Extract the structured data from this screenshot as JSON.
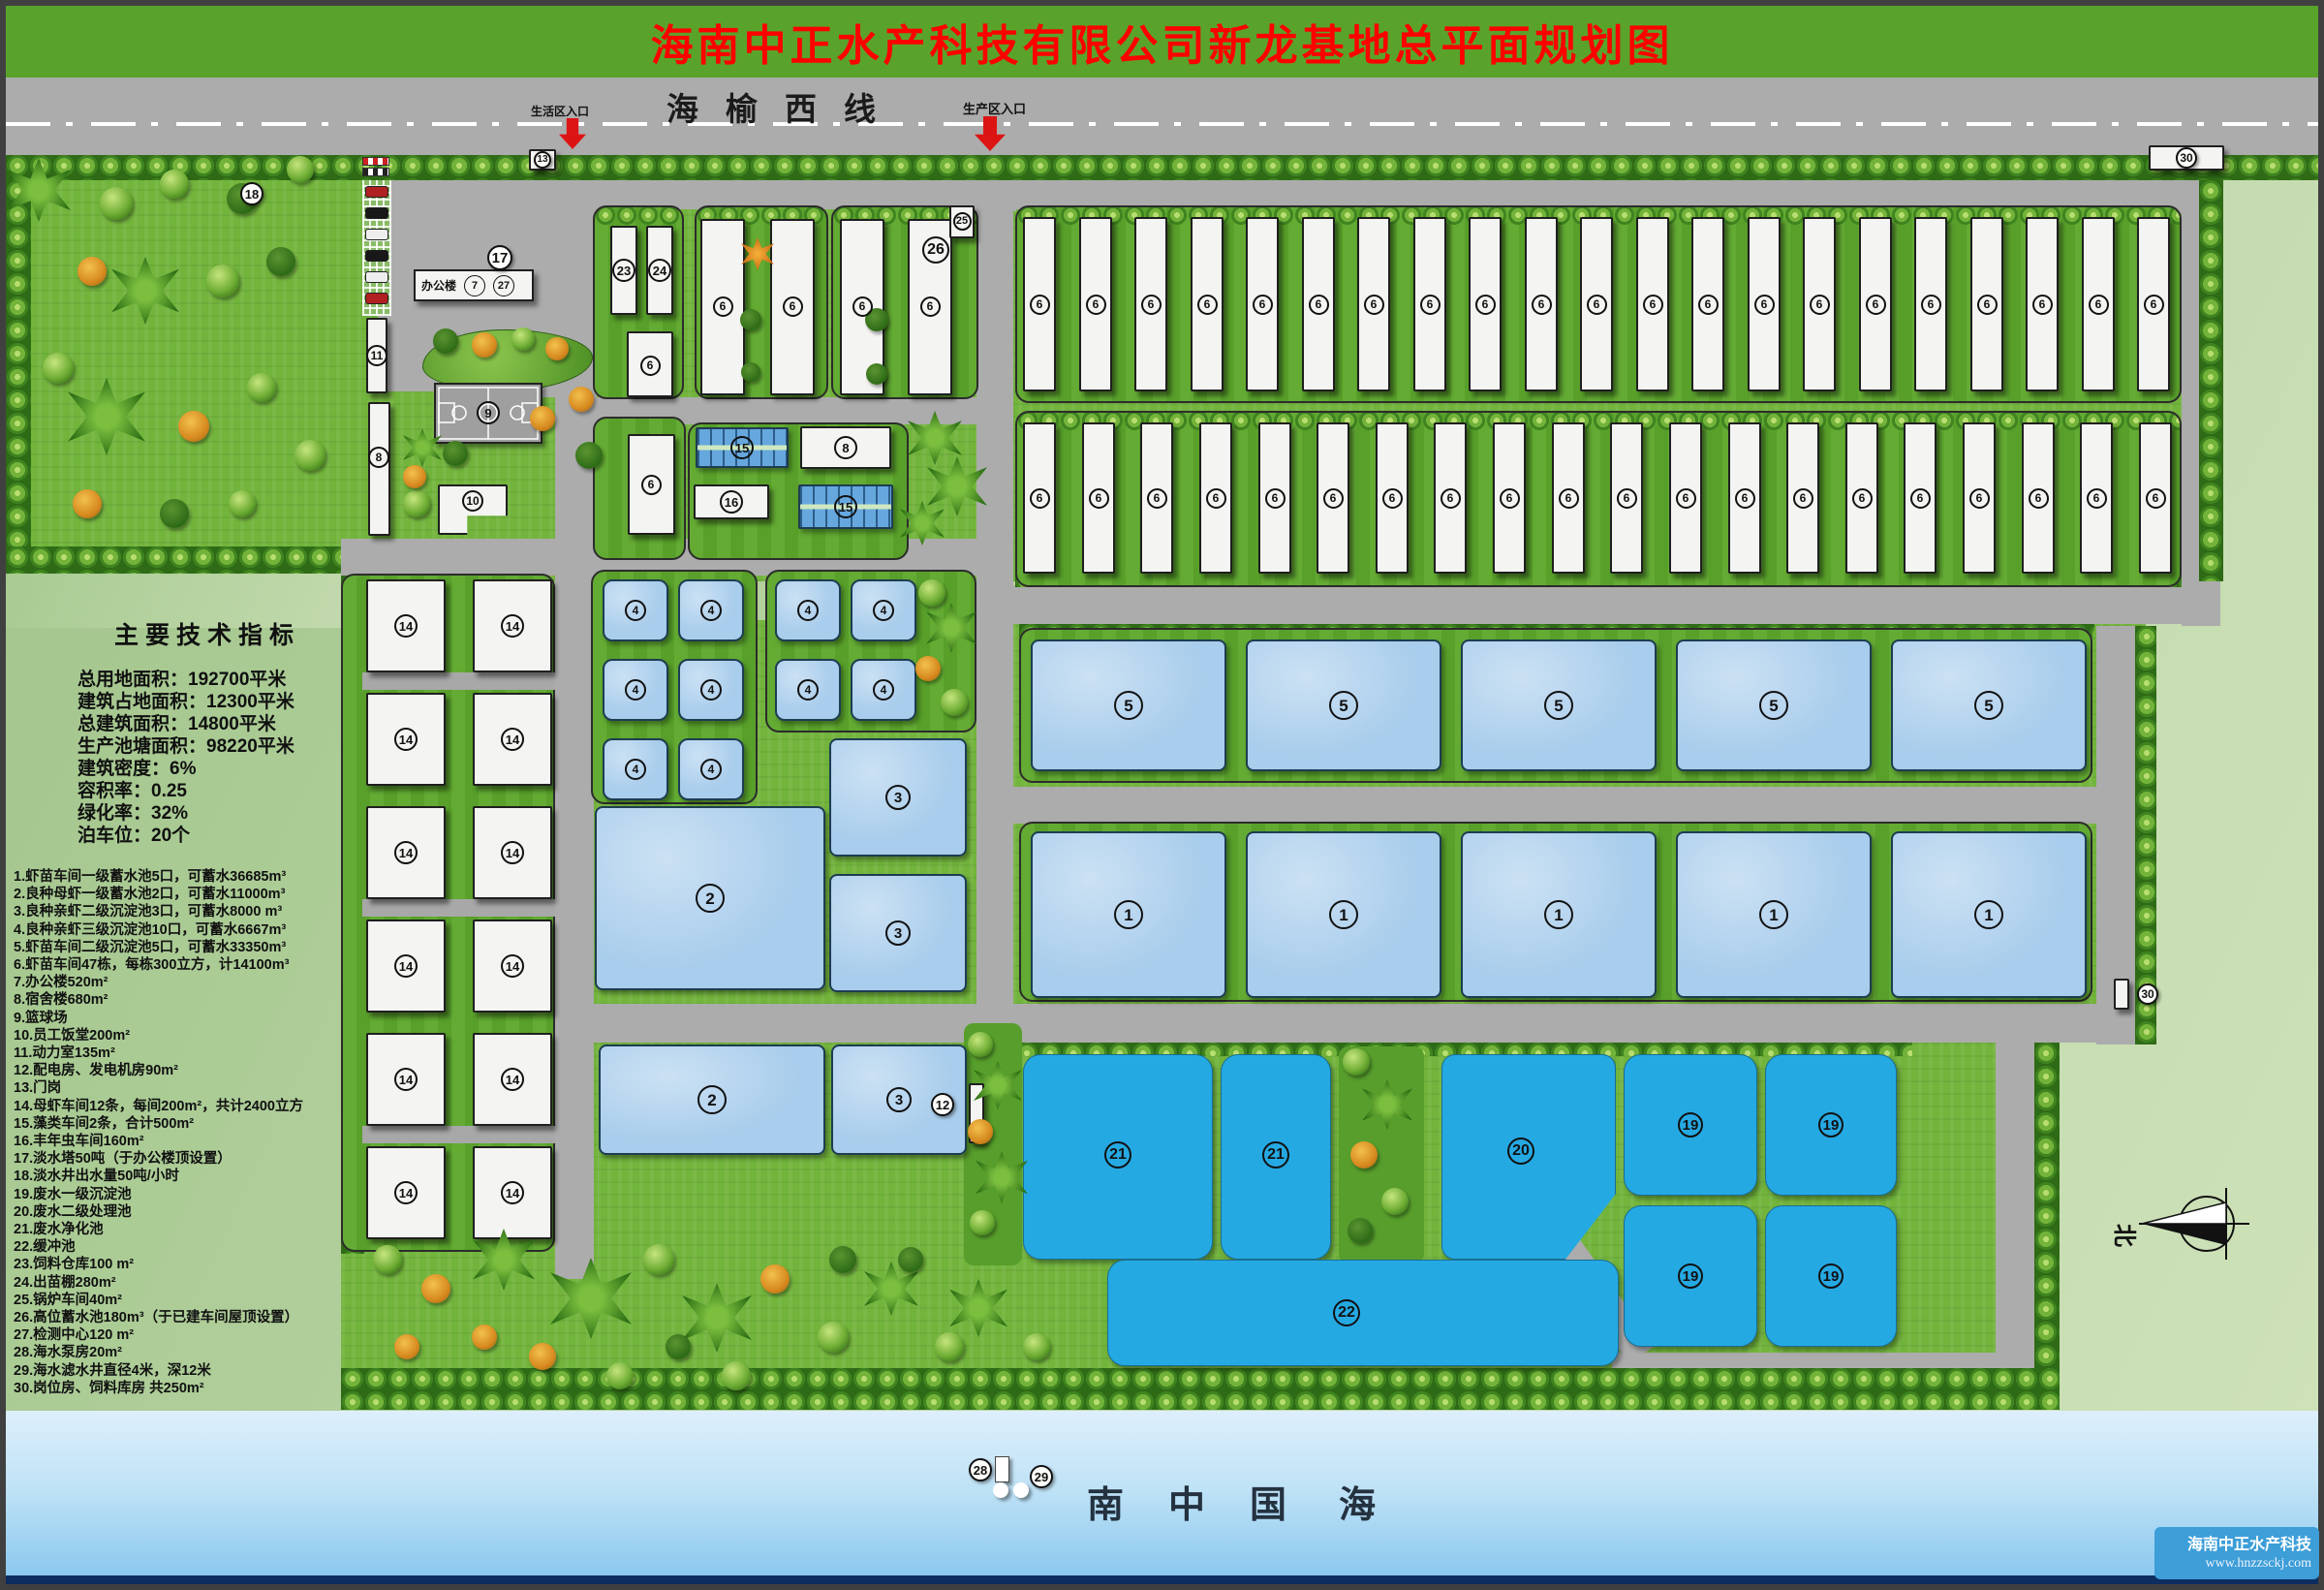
{
  "title": "海南中正水产科技有限公司新龙基地总平面规划图",
  "top_road": {
    "name": "海榆西线",
    "life_entrance": "生活区入口",
    "prod_entrance": "生产区入口"
  },
  "tech_indicators": {
    "title": "主要技术指标",
    "lines": [
      "总用地面积：192700平米",
      "建筑占地面积：12300平米",
      "总建筑面积：14800平米",
      "生产池塘面积：98220平米",
      "建筑密度：6%",
      "容积率：0.25",
      "绿化率：32%",
      "泊车位：20个"
    ]
  },
  "legend": [
    "1.虾苗车间一级蓄水池5口，可蓄水36685m³",
    "2.良种母虾一级蓄水池2口，可蓄水11000m³",
    "3.良种亲虾二级沉淀池3口，可蓄水8000 m³",
    "4.良种亲虾三级沉淀池10口，可蓄水6667m³",
    "5.虾苗车间二级沉淀池5口，可蓄水33350m³",
    "6.虾苗车间47栋，每栋300立方，计14100m³",
    "7.办公楼520m²",
    "8.宿舍楼680m²",
    "9.篮球场",
    "10.员工饭堂200m²",
    "11.动力室135m²",
    "12.配电房、发电机房90m²",
    "13.门岗",
    "14.母虾车间12条，每间200m²，共计2400立方",
    "15.藻类车间2条，合计500m²",
    "16.丰年虫车间160m²",
    "17.淡水塔50吨（于办公楼顶设置）",
    "18.淡水井出水量50吨/小时",
    "19.废水一级沉淀池",
    "20.废水二级处理池",
    "21.废水净化池",
    "22.缓冲池",
    "23.饲料仓库100 m²",
    "24.出苗棚280m²",
    "25.锅炉车间40m²",
    "26.高位蓄水池180m³（于已建车间屋顶设置）",
    "27.检测中心120 m²",
    "28.海水泵房20m²",
    "29.海水滤水井直径4米，深12米",
    "30.岗位房、饲料库房 共250m²"
  ],
  "office_label": "办公楼",
  "circled": {
    "1": "1",
    "2": "2",
    "3": "3",
    "4": "4",
    "5": "5",
    "6": "6",
    "7": "7",
    "8": "8",
    "9": "9",
    "10": "10",
    "11": "11",
    "12": "12",
    "13": "13",
    "14": "14",
    "15": "15",
    "16": "16",
    "17": "17",
    "18": "18",
    "19": "19",
    "20": "20",
    "21": "21",
    "22": "22",
    "23": "23",
    "24": "24",
    "25": "25",
    "26": "26",
    "27": "27",
    "28": "28",
    "29": "29",
    "30": "30"
  },
  "sea": {
    "chars": [
      "南",
      "中",
      "国",
      "海"
    ]
  },
  "watermark": {
    "company": "海南中正水产科技",
    "url": "www.hnzzsckj.com"
  },
  "compass_north": "北",
  "colors": {
    "header_green": "#5aa32b",
    "title_red": "#fe0000",
    "road_gray": "#acacac",
    "grass_green": "#72b43c",
    "pond_light": "#a9cdec",
    "pond_bright": "#25a9e3",
    "sea_top": "#ddeffb",
    "sea_bottom": "#86c6ee",
    "watermark_blue": "#3d9ed8"
  }
}
